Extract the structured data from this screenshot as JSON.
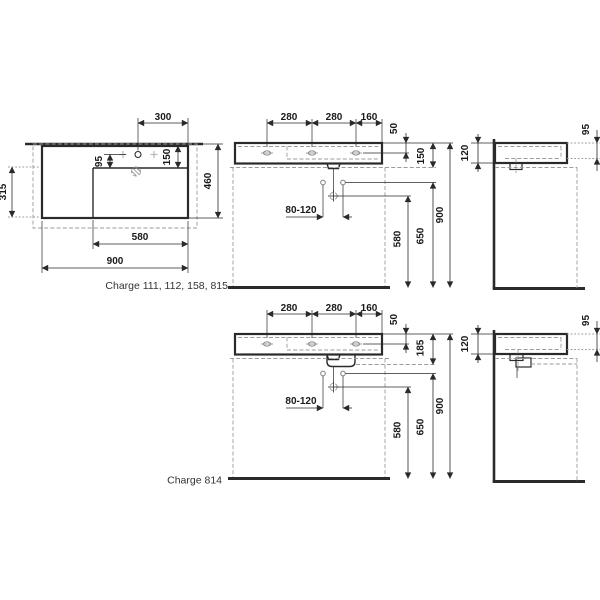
{
  "colors": {
    "line": "#2a2a2a",
    "dashed_gray": "#9b9b9b",
    "light_gray": "#b8b8b8"
  },
  "plan": {
    "label": "Charge 111, 112, 158, 815",
    "dims": {
      "tap_from_right": "300",
      "deck_depth": "150",
      "tap_to_bowl": "95",
      "depth": "460",
      "bowl_depth": "315",
      "bowl_width": "580",
      "width": "900"
    }
  },
  "front_top": {
    "dims": {
      "hole_spacing_left": "280",
      "hole_spacing_mid": "280",
      "hole_to_edge": "160",
      "tap_below_rim": "50",
      "rim_to_underside": "150",
      "supply_range": "80-120",
      "drain_height": "580",
      "fixing_height": "650",
      "rim_height": "900"
    }
  },
  "side_top": {
    "dims": {
      "edge_height": "120",
      "front_edge_height": "95"
    }
  },
  "front_bottom": {
    "label": "Charge 814",
    "dims": {
      "hole_spacing_left": "280",
      "hole_spacing_mid": "280",
      "hole_to_edge": "160",
      "tap_below_rim": "50",
      "rim_to_underside": "185",
      "supply_range": "80-120",
      "drain_height": "580",
      "fixing_height": "650",
      "rim_height": "900"
    }
  },
  "side_bottom": {
    "dims": {
      "edge_height": "120",
      "front_edge_height": "95"
    }
  }
}
